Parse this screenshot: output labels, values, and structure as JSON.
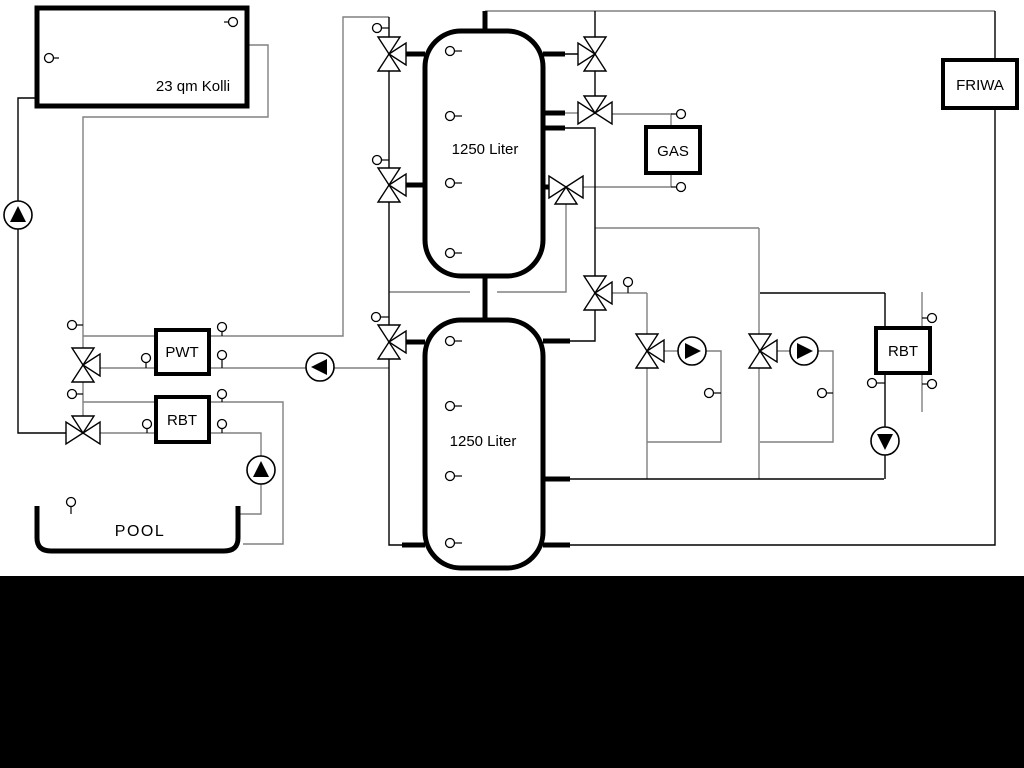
{
  "labels": {
    "collector": "23 qm Kolli",
    "tank_top": "1250 Liter",
    "tank_bottom": "1250 Liter",
    "heat_exchanger": "PWT",
    "rbt_left": "RBT",
    "rbt_right": "RBT",
    "boiler": "GAS",
    "fresh_water": "FRIWA",
    "pool": "POOL"
  },
  "icons": {
    "valve": "three-way-valve-icon",
    "pump": "pump-icon",
    "sensor": "temperature-sensor-icon"
  },
  "colors": {
    "pipe_gray": "#808080",
    "pipe_black": "#000000",
    "component_outline": "#000000",
    "box_fill": "#ffffff",
    "background": "#ffffff",
    "footer_band": "#000000"
  }
}
